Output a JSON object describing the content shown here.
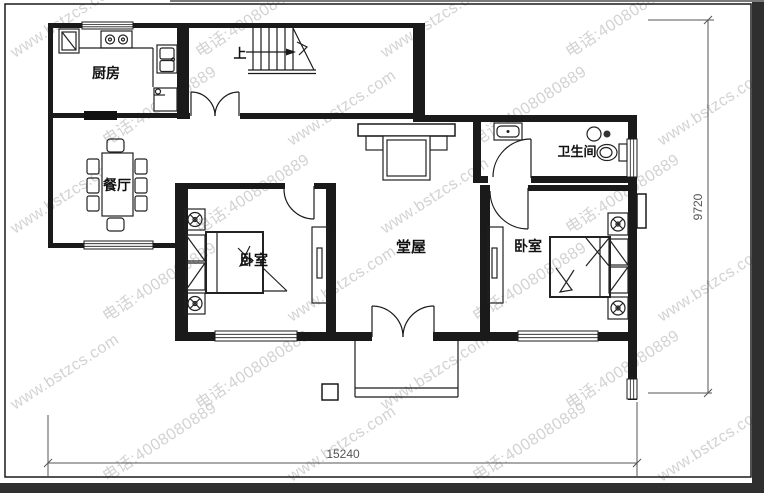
{
  "image": {
    "kind": "house-floor-plan"
  },
  "colors": {
    "line": "#1a1a1a",
    "dimension_text": "#555555",
    "watermark": "#c7c7c7",
    "edge_band": "#2f2f2f",
    "background": "#ffffff"
  },
  "watermark": {
    "site": "www.bstzcs.com",
    "phone": "电话:4008080889"
  },
  "labels": {
    "kitchen": "厨房",
    "dining": "餐厅",
    "bedroom_left": "卧室",
    "bedroom_right": "卧室",
    "hall": "堂屋",
    "bathroom": "卫生间",
    "stairs_up": "上"
  },
  "dimensions": {
    "bottom": "15240",
    "right": "9720"
  }
}
